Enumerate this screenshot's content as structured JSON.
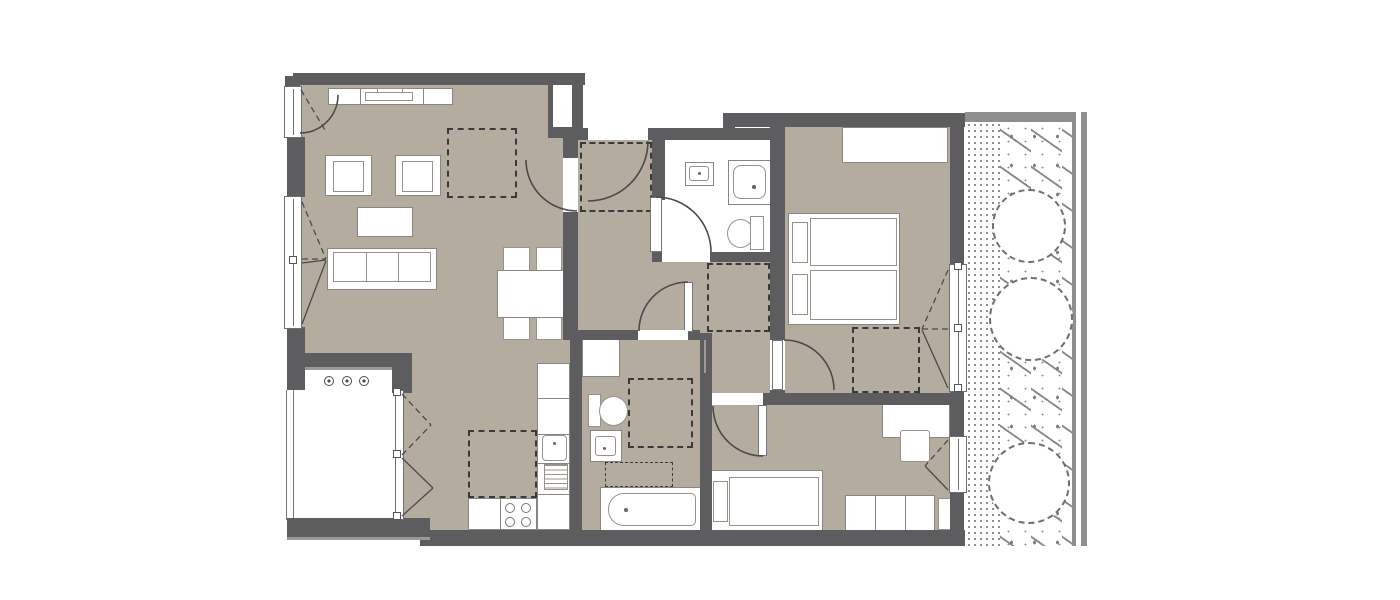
{
  "document": {
    "kind": "architectural floor plan",
    "has_text": false
  },
  "colors": {
    "floor": "#b5aca0",
    "wall": "#5d5d5f",
    "furniture_outline": "#8a867f",
    "dashed_line": "#3a3a3a",
    "door_arc": "#4a4a4a",
    "garden_speckle": "#8f8f8f",
    "background": "#ffffff"
  },
  "rooms": [
    {
      "name": "living-room",
      "items": [
        "tv-sideboard",
        "tv",
        "armchair",
        "armchair",
        "coffee-table",
        "sofa-3-seat",
        "dining-table",
        "dining-chair-x4",
        "dashed-square"
      ]
    },
    {
      "name": "kitchen",
      "items": [
        "counter-run",
        "kitchen-sink",
        "appliance-hatched",
        "stove-4-burners",
        "dashed-island"
      ]
    },
    {
      "name": "entry-hall",
      "items": [
        "dashed-wardrobe",
        "entrance-door-arc"
      ]
    },
    {
      "name": "hallway",
      "items": [
        "dashed-wardrobe"
      ]
    },
    {
      "name": "bathroom-1",
      "items": [
        "washbasin",
        "shower",
        "toilet",
        "door-arc"
      ]
    },
    {
      "name": "bathroom-2",
      "items": [
        "washing-machine",
        "toilet",
        "washbasin",
        "bathtub",
        "dashed-square",
        "dashed-screen"
      ]
    },
    {
      "name": "bedroom-1",
      "items": [
        "wardrobe",
        "double-bed-two-mattresses",
        "pillow-x2",
        "dashed-wardrobe",
        "door-arc",
        "window"
      ]
    },
    {
      "name": "bedroom-2",
      "items": [
        "desk",
        "chair",
        "single-bed",
        "pillow",
        "sideboard-3-units",
        "door-arc",
        "window"
      ]
    },
    {
      "name": "balcony",
      "items": [
        "spotlight-x3",
        "glazed-door",
        "railing"
      ]
    },
    {
      "name": "garden-strip",
      "items": [
        "gravel-band",
        "lawn",
        "tree-circle",
        "tree-circle",
        "tree-circle"
      ]
    }
  ],
  "window_count": 5,
  "door_arc_count": 7
}
